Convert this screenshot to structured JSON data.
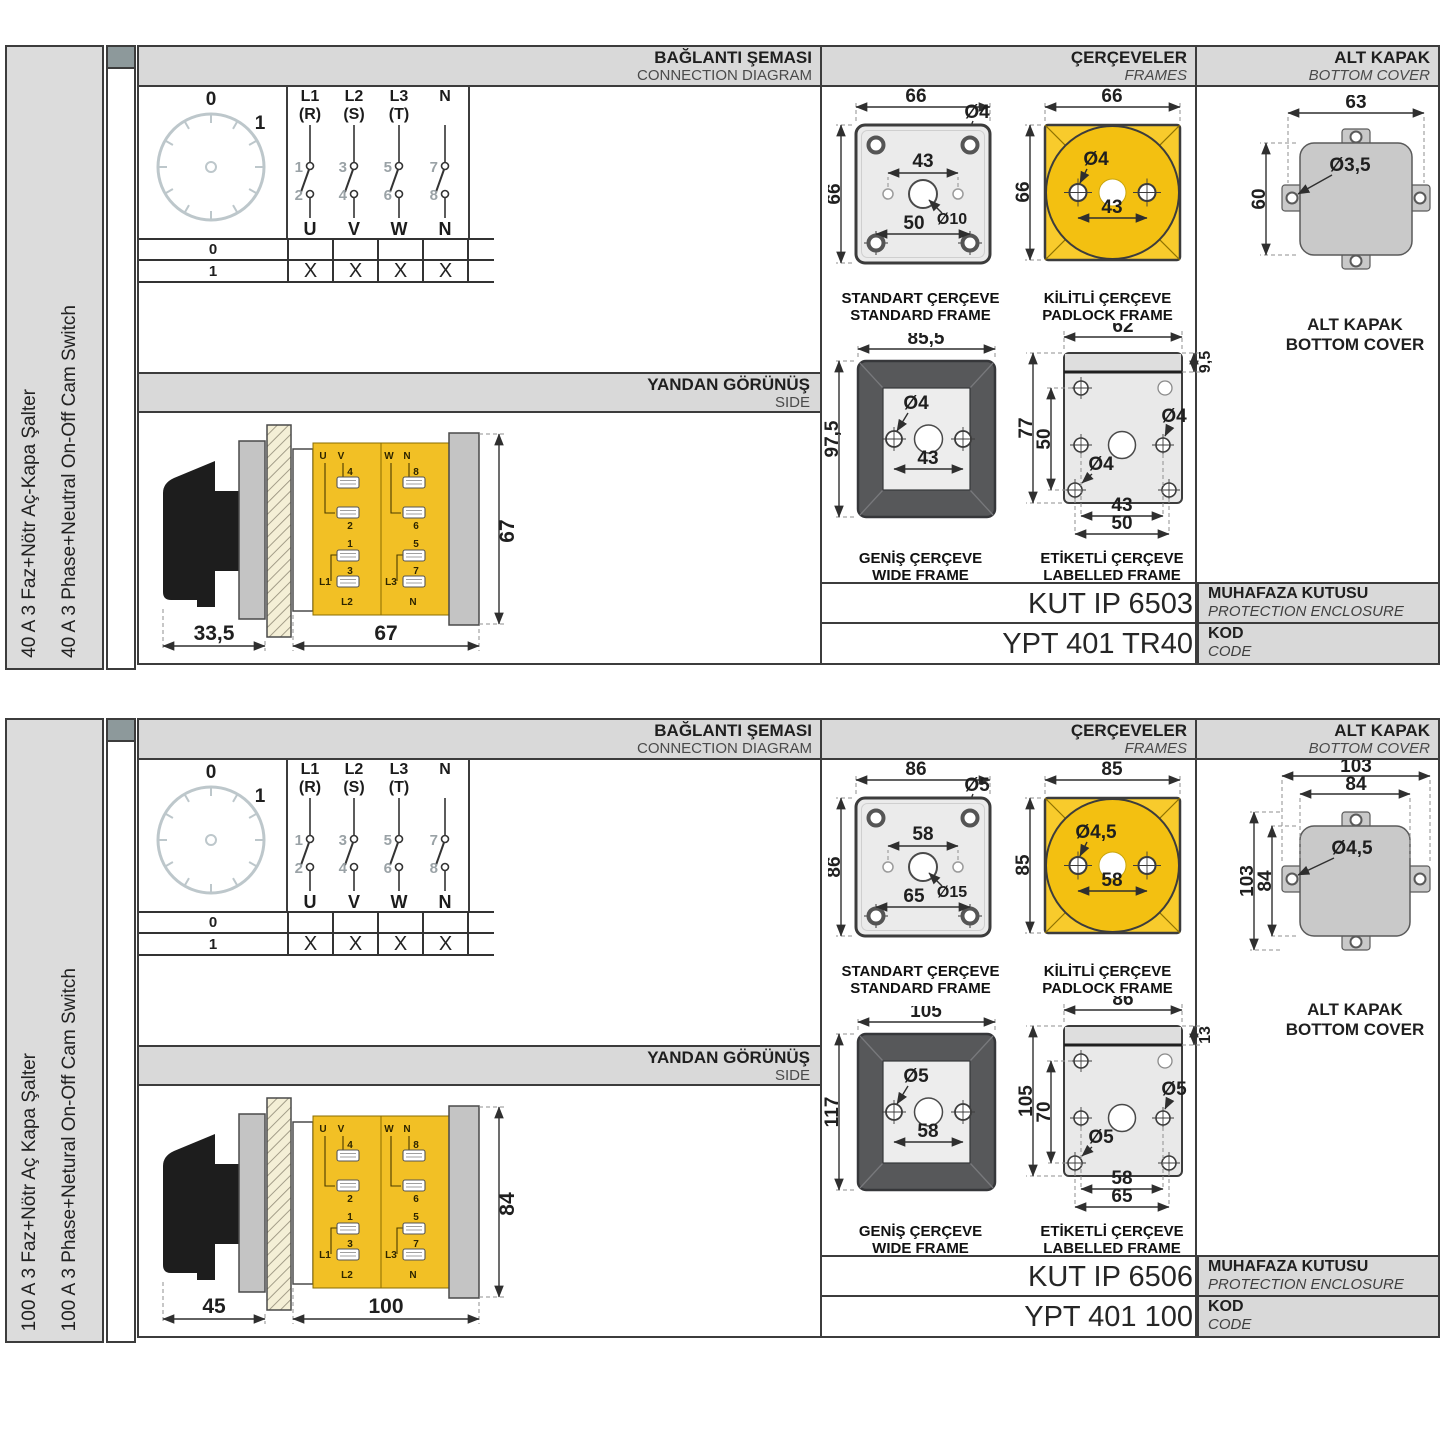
{
  "colors": {
    "panel_gray": "#d9d9d9",
    "label_gray": "#dcdcdc",
    "binder_cap": "#8d999b",
    "yellow_frame": "#f8cb2c",
    "yellow_circle": "#f3c011",
    "yellow_body": "#f2c025",
    "dark_frame": "#57585a",
    "frame_fill": "#ebebeb",
    "cover_gray": "#c9c9c9",
    "border": "#3c3c3c"
  },
  "panels": [
    {
      "side_label_tr": "40 A 3 Faz+Nötr Aç-Kapa Şalter",
      "side_label_en": "40 A 3 Phase+Neutral On-Off Cam Switch",
      "header": {
        "connection_tr": "BAĞLANTI ŞEMASI",
        "connection_en": "CONNECTION DIAGRAM",
        "frames_tr": "ÇERÇEVELER",
        "frames_en": "FRAMES",
        "cover_tr": "ALT KAPAK",
        "cover_en": "BOTTOM COVER"
      },
      "diagram": {
        "dial_pos0": "0",
        "dial_pos1": "1",
        "columns": [
          {
            "l1": "L1",
            "l2": "(R)",
            "nin": "1",
            "nout": "2",
            "out": "U"
          },
          {
            "l1": "L2",
            "l2": "(S)",
            "nin": "3",
            "nout": "4",
            "out": "V"
          },
          {
            "l1": "L3",
            "l2": "(T)",
            "nin": "5",
            "nout": "6",
            "out": "W"
          },
          {
            "l1": "N",
            "l2": "",
            "nin": "7",
            "nout": "8",
            "out": "N"
          }
        ],
        "table": {
          "row0": "0",
          "row1": "1",
          "mark": "X"
        }
      },
      "side_view": {
        "title_tr": "YANDAN GÖRÜNÜŞ",
        "title_en": "SIDE",
        "dim_front": "33,5",
        "dim_depth": "67",
        "dim_height": "67",
        "t": [
          "U",
          "V",
          "4",
          "2",
          "1",
          "3",
          "L1",
          "L2",
          "W",
          "N",
          "8",
          "6",
          "5",
          "7",
          "L3",
          "N"
        ]
      },
      "frames": {
        "standard": {
          "tr": "STANDART ÇERÇEVE",
          "en": "STANDARD FRAME",
          "w": "66",
          "h": "66",
          "hole": "Ø4",
          "span_in": "43",
          "hole_c": "Ø10",
          "span_out": "50"
        },
        "padlock": {
          "tr": "KİLİTLİ ÇERÇEVE",
          "en": "PADLOCK FRAME",
          "w": "66",
          "h": "66",
          "hole": "Ø4",
          "span": "43"
        },
        "wide": {
          "tr": "GENİŞ ÇERÇEVE",
          "en": "WIDE FRAME",
          "w": "85,5",
          "h": "97,5",
          "hole": "Ø4",
          "span": "43"
        },
        "labelled": {
          "tr": "ETİKETLİ ÇERÇEVE",
          "en": "LABELLED FRAME",
          "w": "62",
          "strip": "9,5",
          "h": "77",
          "h_in": "50",
          "hole1": "Ø4",
          "hole2": "Ø4",
          "span_in": "43",
          "span_out": "50"
        }
      },
      "cover": {
        "w": "63",
        "h": "60",
        "hole": "Ø3,5",
        "tr": "ALT KAPAK",
        "en": "BOTTOM COVER"
      },
      "codes": {
        "enclosure": "KUT IP 6503",
        "enclosure_tr": "MUHAFAZA KUTUSU",
        "enclosure_en": "PROTECTION ENCLOSURE",
        "code": "YPT 401 TR40",
        "code_tr": "KOD",
        "code_en": "CODE"
      }
    },
    {
      "side_label_tr": "100 A 3 Faz+Nötr Aç Kapa Şalter",
      "side_label_en": "100 A 3 Phase+Netural On-Off Cam Switch",
      "header": {
        "connection_tr": "BAĞLANTI ŞEMASI",
        "connection_en": "CONNECTION DIAGRAM",
        "frames_tr": "ÇERÇEVELER",
        "frames_en": "FRAMES",
        "cover_tr": "ALT KAPAK",
        "cover_en": "BOTTOM COVER"
      },
      "diagram": {
        "dial_pos0": "0",
        "dial_pos1": "1",
        "columns": [
          {
            "l1": "L1",
            "l2": "(R)",
            "nin": "1",
            "nout": "2",
            "out": "U"
          },
          {
            "l1": "L2",
            "l2": "(S)",
            "nin": "3",
            "nout": "4",
            "out": "V"
          },
          {
            "l1": "L3",
            "l2": "(T)",
            "nin": "5",
            "nout": "6",
            "out": "W"
          },
          {
            "l1": "N",
            "l2": "",
            "nin": "7",
            "nout": "8",
            "out": "N"
          }
        ],
        "table": {
          "row0": "0",
          "row1": "1",
          "mark": "X"
        }
      },
      "side_view": {
        "title_tr": "YANDAN GÖRÜNÜŞ",
        "title_en": "SIDE",
        "dim_front": "45",
        "dim_depth": "100",
        "dim_height": "84",
        "t": [
          "U",
          "V",
          "4",
          "2",
          "1",
          "3",
          "L1",
          "L2",
          "W",
          "N",
          "8",
          "6",
          "5",
          "7",
          "L3",
          "N"
        ]
      },
      "frames": {
        "standard": {
          "tr": "STANDART ÇERÇEVE",
          "en": "STANDARD FRAME",
          "w": "86",
          "h": "86",
          "hole": "Ø5",
          "span_in": "58",
          "hole_c": "Ø15",
          "span_out": "65"
        },
        "padlock": {
          "tr": "KİLİTLİ ÇERÇEVE",
          "en": "PADLOCK FRAME",
          "w": "85",
          "h": "85",
          "hole": "Ø4,5",
          "span": "58"
        },
        "wide": {
          "tr": "GENİŞ ÇERÇEVE",
          "en": "WIDE FRAME",
          "w": "105",
          "h": "117",
          "hole": "Ø5",
          "span": "58"
        },
        "labelled": {
          "tr": "ETİKETLİ ÇERÇEVE",
          "en": "LABELLED FRAME",
          "w": "86",
          "strip": "13",
          "h": "105",
          "h_in": "70",
          "hole1": "Ø5",
          "hole2": "Ø5",
          "span_in": "58",
          "span_out": "65"
        }
      },
      "cover": {
        "w_out": "103",
        "w_in": "84",
        "h_out": "103",
        "h_in": "84",
        "hole": "Ø4,5",
        "tr": "ALT KAPAK",
        "en": "BOTTOM COVER"
      },
      "codes": {
        "enclosure": "KUT IP 6506",
        "enclosure_tr": "MUHAFAZA KUTUSU",
        "enclosure_en": "PROTECTION ENCLOSURE",
        "code": "YPT 401 100",
        "code_tr": "KOD",
        "code_en": "CODE"
      }
    }
  ]
}
